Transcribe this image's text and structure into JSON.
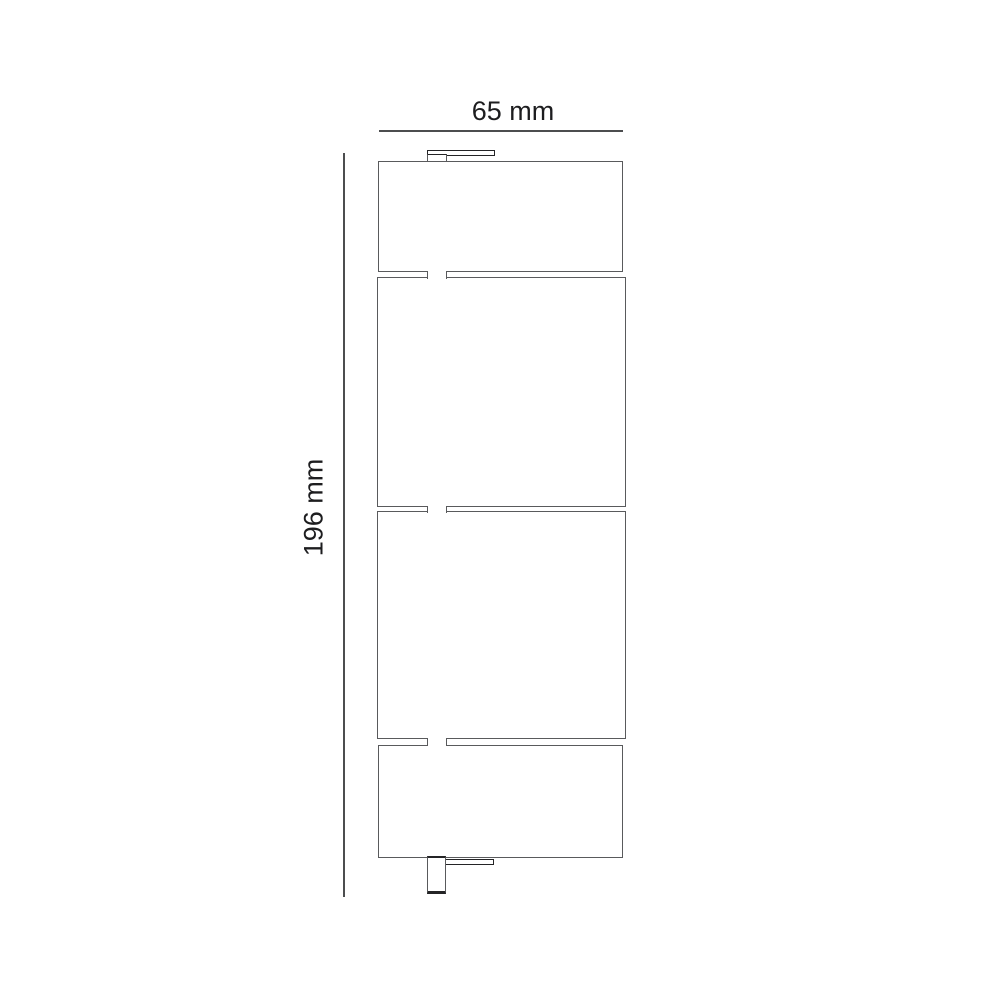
{
  "diagram": {
    "type": "technical-dimension-drawing",
    "view": "side-profile",
    "subject": "vertical four-panel unit with mounting tabs",
    "panels": [
      {
        "name": "top-panel",
        "position": 1
      },
      {
        "name": "upper-middle-panel",
        "position": 2
      },
      {
        "name": "lower-middle-panel",
        "position": 3
      },
      {
        "name": "bottom-panel",
        "position": 4
      }
    ],
    "connectors": [
      {
        "name": "top-mounting-bracket"
      },
      {
        "name": "panel-junction-tab-1"
      },
      {
        "name": "panel-junction-tab-2"
      },
      {
        "name": "panel-junction-tab-3"
      },
      {
        "name": "bottom-connector-plug"
      },
      {
        "name": "bottom-mounting-bracket"
      }
    ]
  },
  "dimensions": {
    "width": {
      "label": "65 mm",
      "value": 65,
      "unit": "mm"
    },
    "height": {
      "label": "196 mm",
      "value": 196,
      "unit": "mm"
    }
  },
  "colors": {
    "background": "#ffffff",
    "line": "#595a5c",
    "line-dark": "#242426",
    "dimline": "#4c4d4f",
    "text": "#1d1d1f"
  }
}
